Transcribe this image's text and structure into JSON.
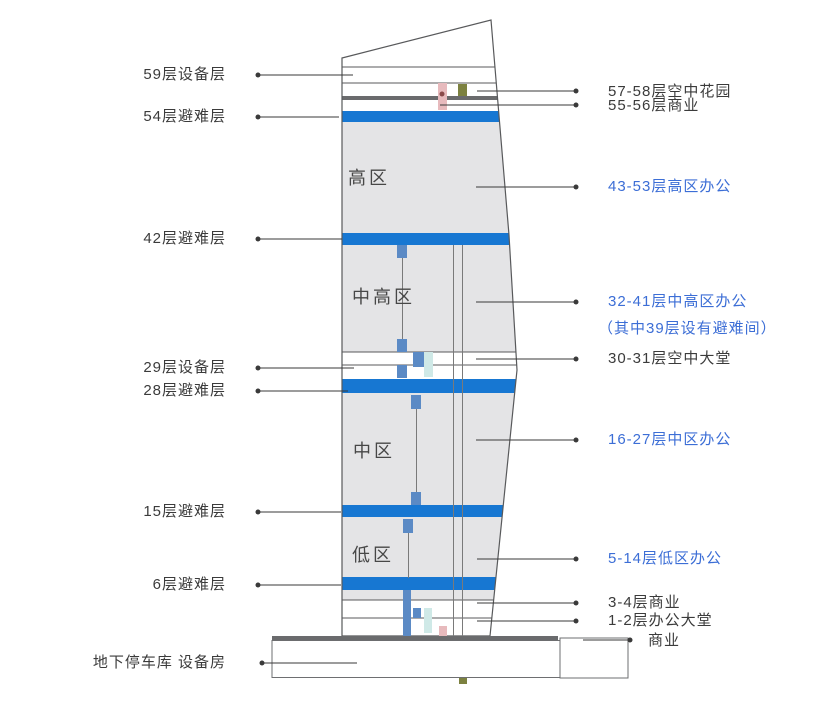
{
  "diagram": {
    "left_labels": [
      {
        "text": "59层设备层"
      },
      {
        "text": "54层避难层"
      },
      {
        "text": "42层避难层"
      },
      {
        "text": "29层设备层"
      },
      {
        "text": "28层避难层"
      },
      {
        "text": "15层避难层"
      },
      {
        "text": "6层避难层"
      },
      {
        "text": "地下停车库 设备房"
      }
    ],
    "right_labels": [
      {
        "text": "57-58层空中花园",
        "style": "dark"
      },
      {
        "text": "55-56层商业",
        "style": "dark"
      },
      {
        "text": "43-53层高区办公",
        "style": "blue"
      },
      {
        "text": "32-41层中高区办公",
        "style": "blue"
      },
      {
        "text": "（其中39层设有避难间）",
        "style": "blue"
      },
      {
        "text": "30-31层空中大堂",
        "style": "dark"
      },
      {
        "text": "16-27层中区办公",
        "style": "blue"
      },
      {
        "text": "5-14层低区办公",
        "style": "blue"
      },
      {
        "text": "3-4层商业",
        "style": "dark"
      },
      {
        "text": "1-2层办公大堂",
        "style": "dark"
      },
      {
        "text": "商业",
        "style": "dark"
      }
    ],
    "zone_labels": [
      {
        "text": "高区"
      },
      {
        "text": "中高区"
      },
      {
        "text": "中区"
      },
      {
        "text": "低区"
      }
    ],
    "colors": {
      "refuge_band_blue": "#1777d2",
      "blue_text": "#3c6ed6",
      "dark_text": "#3b3b3b",
      "body_gray": "#e4e4e6",
      "outline_gray": "#58595b",
      "thick_bar_gray": "#6a6b6d",
      "shaft_blue": "#5b8ac5",
      "shaft_cyan": "#cfe9e7",
      "shaft_pink": "#e7babd",
      "shaft_olive": "#7c8140",
      "shaft_gray": "#b5b5b7",
      "leader_line": "#3a3a3a"
    }
  }
}
